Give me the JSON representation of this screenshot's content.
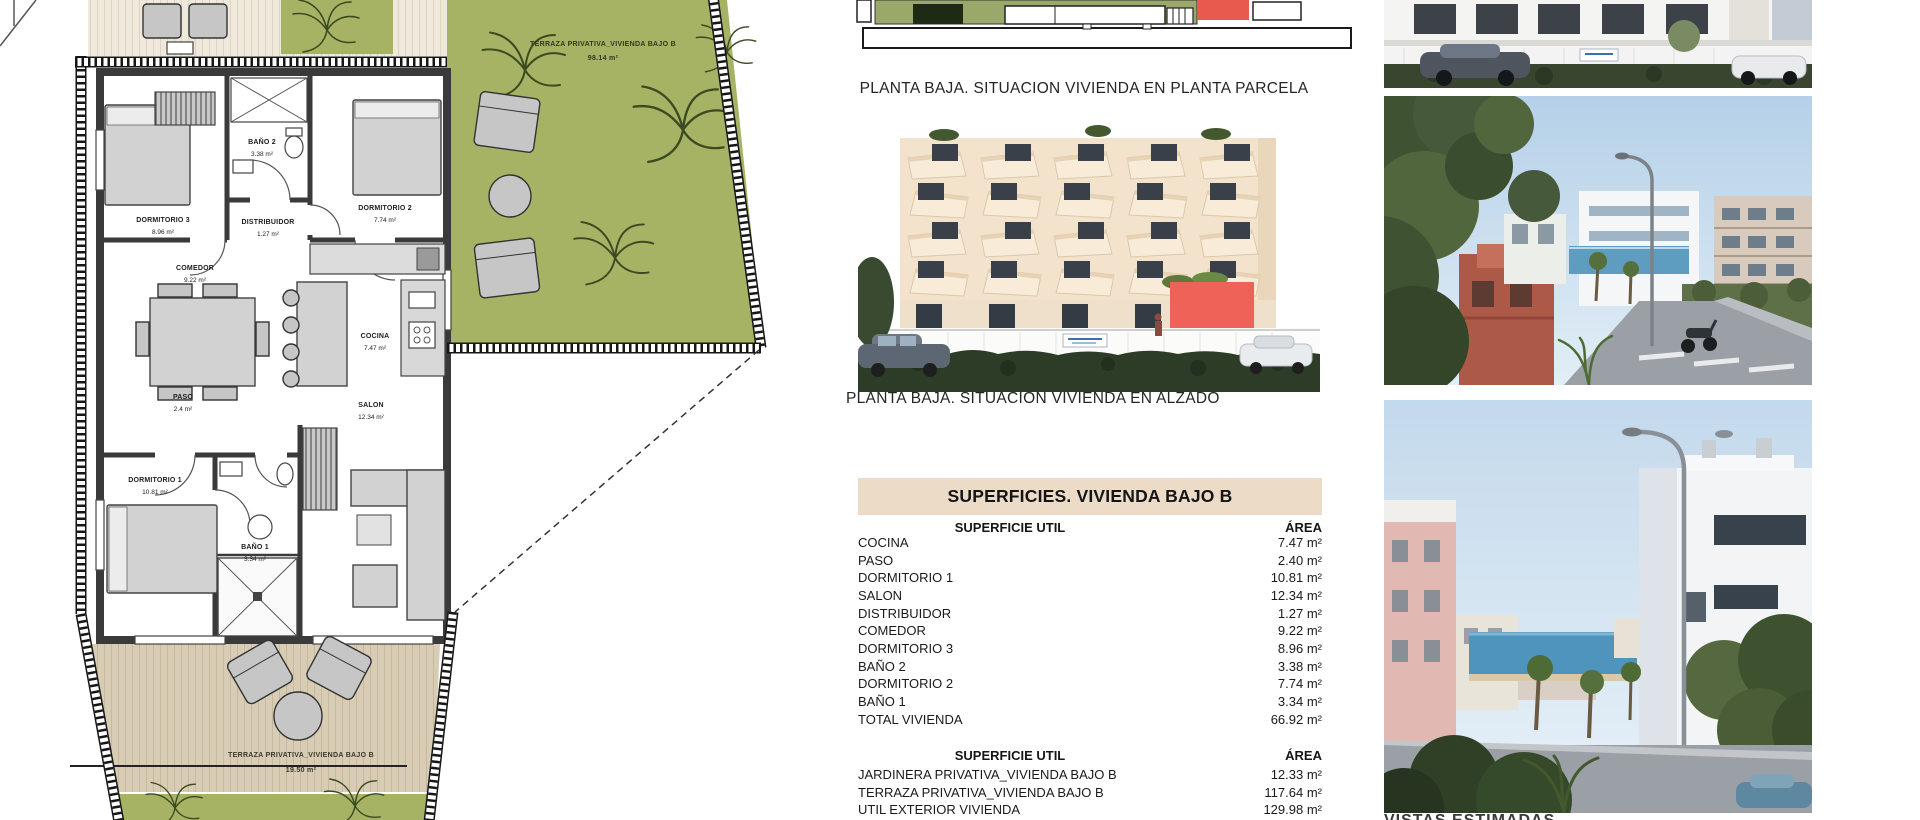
{
  "colors": {
    "terrace_green": "#a6b264",
    "terrace_boards": "#d8cdb4",
    "table_header_bg": "#ecdbc7",
    "highlight_red": "#ee6257",
    "siteplan_red": "#e8594e",
    "wall_dark": "#3a3a3a"
  },
  "floorplan": {
    "terrace_top": {
      "label": "TERRAZA PRIVATIVA_VIVIENDA BAJO B",
      "area": "98.14 m²"
    },
    "terrace_bottom": {
      "label": "TERRAZA PRIVATIVA_VIVIENDA BAJO B",
      "area": "19.50 m²"
    },
    "rooms": [
      {
        "label": "DORMITORIO 3",
        "area": "8.96 m²"
      },
      {
        "label": "BAÑO 2",
        "area": "3.38 m²"
      },
      {
        "label": "DORMITORIO 2",
        "area": "7.74 m²"
      },
      {
        "label": "DISTRIBUIDOR",
        "area": "1.27 m²"
      },
      {
        "label": "COMEDOR",
        "area": "9.22 m²"
      },
      {
        "label": "COCINA",
        "area": "7.47 m²"
      },
      {
        "label": "PASO",
        "area": "2.4 m²"
      },
      {
        "label": "SALON",
        "area": "12.34 m²"
      },
      {
        "label": "DORMITORIO 1",
        "area": "10.81 m²"
      },
      {
        "label": "BAÑO 1",
        "area": "3.34 m²"
      }
    ]
  },
  "middle": {
    "caption_parcela": "PLANTA BAJA. SITUACION VIVIENDA EN PLANTA PARCELA",
    "caption_alzado": "PLANTA BAJA. SITUACION VIVIENDA EN ALZADO",
    "table": {
      "title": "SUPERFICIES. VIVIENDA BAJO B",
      "col_label": "SUPERFICIE UTIL",
      "col_area": "ÁREA",
      "rows": [
        {
          "label": "COCINA",
          "area": "7.47 m²"
        },
        {
          "label": "PASO",
          "area": "2.40 m²"
        },
        {
          "label": "DORMITORIO 1",
          "area": "10.81 m²"
        },
        {
          "label": "SALON",
          "area": "12.34 m²"
        },
        {
          "label": "DISTRIBUIDOR",
          "area": "1.27 m²"
        },
        {
          "label": "COMEDOR",
          "area": "9.22 m²"
        },
        {
          "label": "DORMITORIO 3",
          "area": "8.96 m²"
        },
        {
          "label": "BAÑO 2",
          "area": "3.38 m²"
        },
        {
          "label": "DORMITORIO 2",
          "area": "7.74 m²"
        },
        {
          "label": "BAÑO 1",
          "area": "3.34 m²"
        },
        {
          "label": "TOTAL VIVIENDA",
          "area": "66.92 m²"
        }
      ],
      "col_label2": "SUPERFICIE UTIL",
      "col_area2": "ÁREA",
      "rows2": [
        {
          "label": "JARDINERA PRIVATIVA_VIVIENDA BAJO B",
          "area": "12.33 m²"
        },
        {
          "label": "TERRAZA PRIVATIVA_VIVIENDA BAJO B",
          "area": "117.64 m²"
        },
        {
          "label": "UTIL EXTERIOR VIVIENDA",
          "area": "129.98 m²"
        }
      ]
    }
  },
  "right": {
    "caption": "VISTAS ESTIMADAS"
  }
}
